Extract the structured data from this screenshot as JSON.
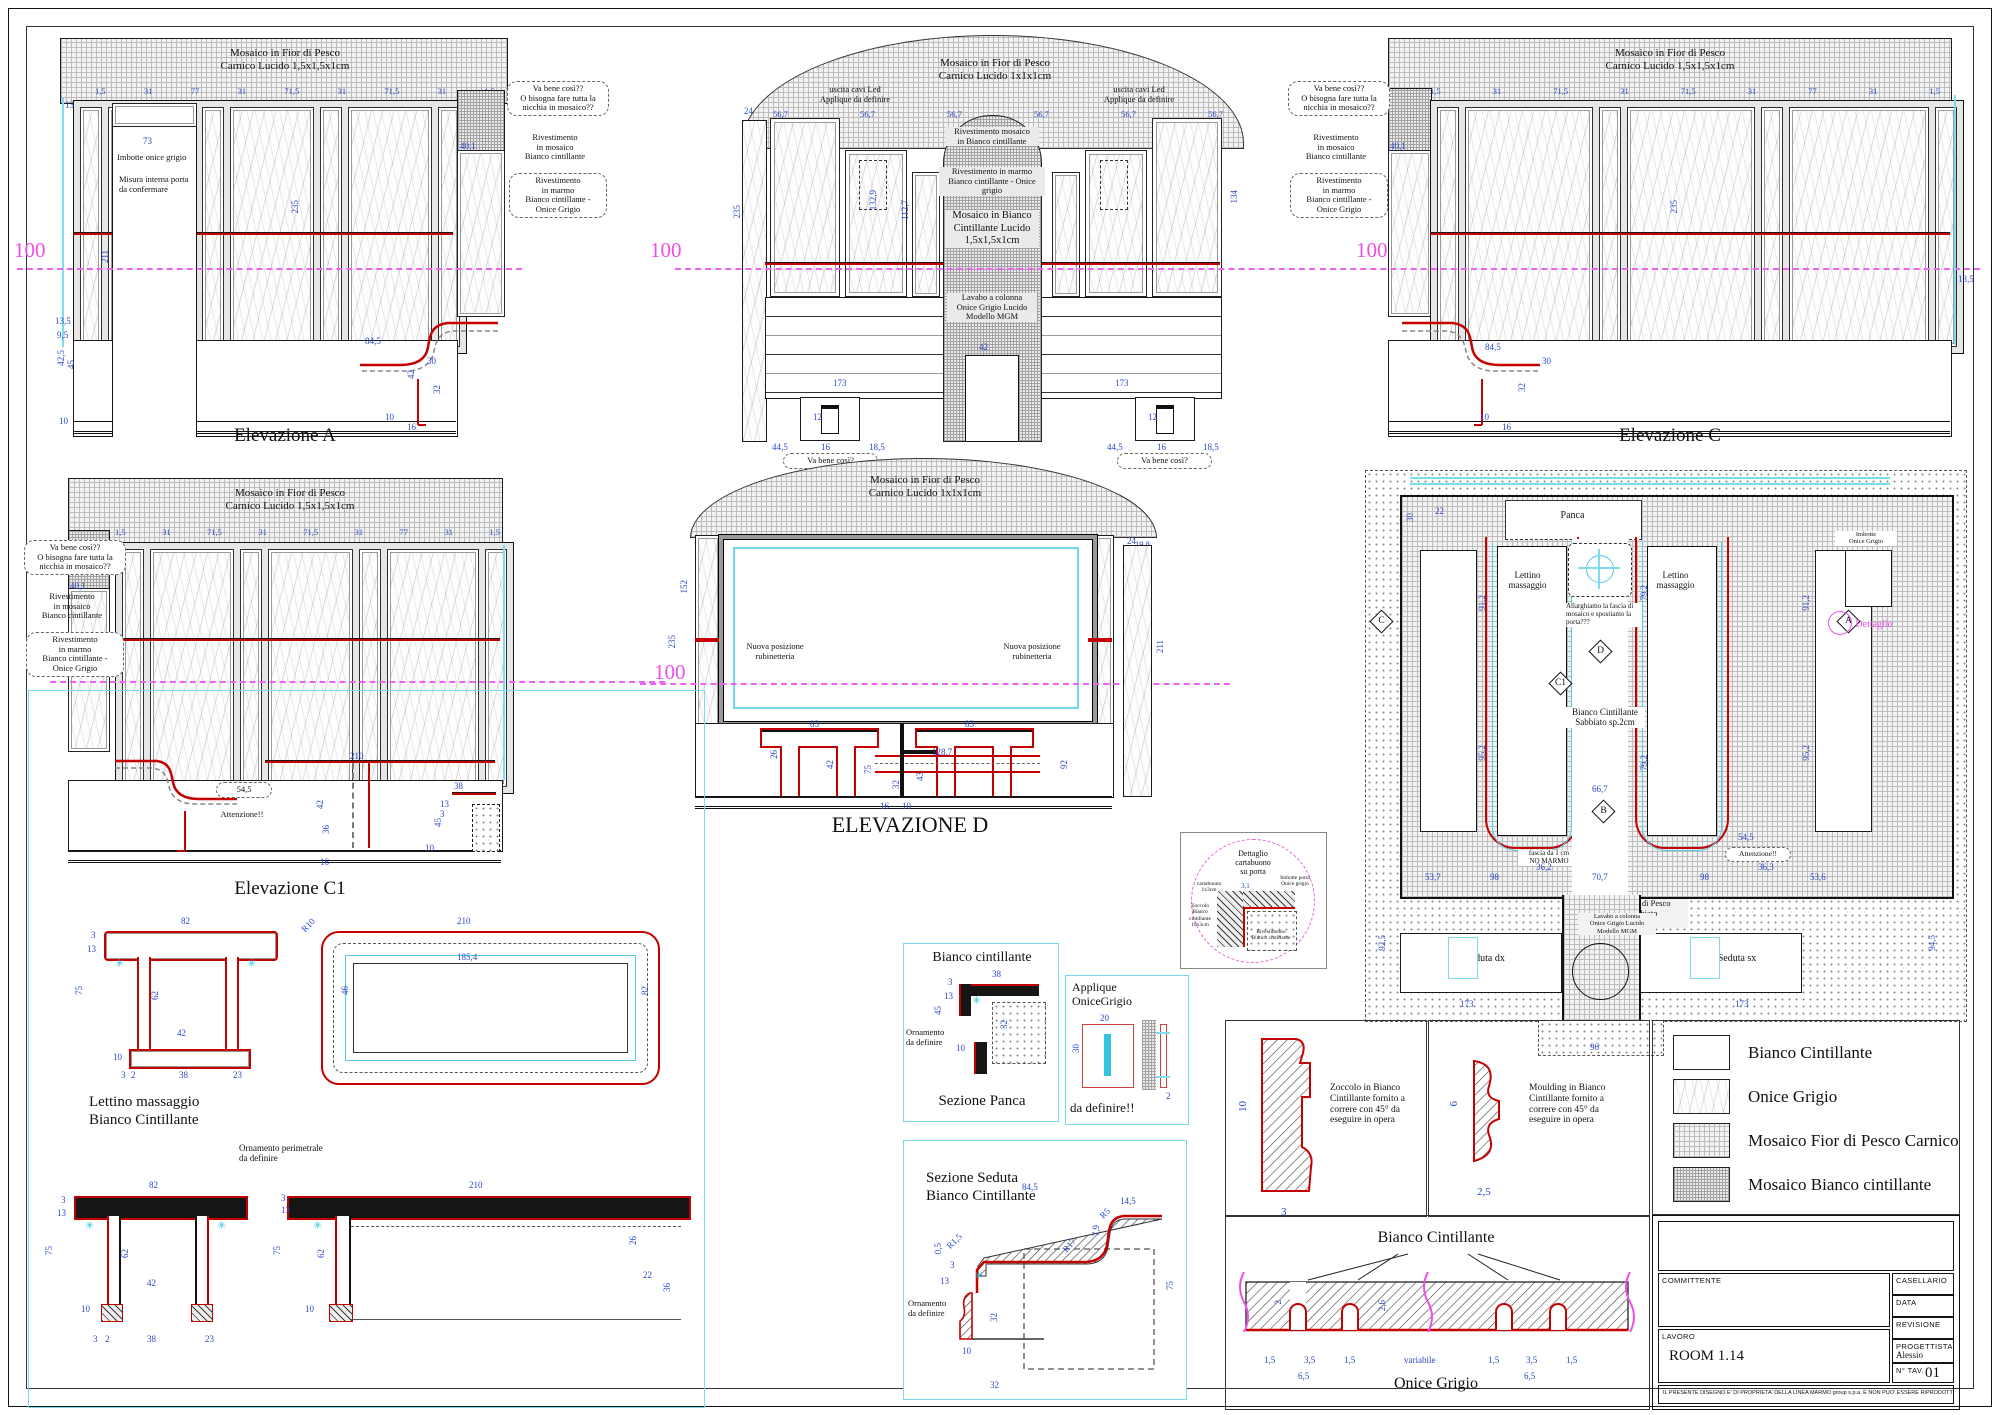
{
  "sheet": {
    "level": "100"
  },
  "elevA": {
    "title": "Elevazione A",
    "mosaic": "Mosaico in Fior di Pesco\nCarnico Lucido 1,5x1,5x1cm",
    "top_dims": [
      "1,5",
      "31",
      "77",
      "31",
      "71,5",
      "31",
      "71,5",
      "31",
      "1,5"
    ],
    "dims": {
      "d13": "13",
      "door_w": "73",
      "h_door": "211",
      "h_panel": "235",
      "niche": "40,1",
      "l1": "13,5",
      "l2": "9,5",
      "l3": "42,5",
      "l4": "45",
      "l5": "10",
      "s1": "84,5",
      "s2": "30",
      "s3": "42",
      "s4": "32",
      "s5": "16",
      "s6": "10"
    },
    "notes": {
      "imbotte": "Imbotte onice grigio",
      "misura": "Misura interna porta\nda confermare",
      "q1": "Va bene così??\nO bisogna fare tutta la\nnicchia in mosaico??",
      "rmos": "Rivestimento\nin mosaico\nBianco cintillante",
      "rmarmo": "Rivestimento\nin marmo\nBianco cintillante -\nOnice Grigio"
    }
  },
  "elevB": {
    "title": "Elevazione B",
    "mosaic": "Mosaico in Fior di Pesco\nCarnico Lucido 1x1x1cm",
    "top_dims": [
      "56,7",
      "56,7",
      "56,7",
      "56,7",
      "56,7",
      "56,7"
    ],
    "dims": {
      "d24": "24",
      "h": "235",
      "v1": "112,7",
      "v2": "132,9",
      "v3": "134",
      "lav": "42",
      "b173a": "173",
      "b173b": "173",
      "p1": "44,5",
      "p2": "16",
      "p3": "18,5",
      "p4": "44,5",
      "p5": "16",
      "p6": "18,5",
      "plug1": "12",
      "plug2": "12"
    },
    "notes": {
      "led1": "uscita cavi Led\nApplique da definire",
      "led2": "uscita cavi Led\nApplique da definire",
      "rmos": "Rivestimento mosaico\nin Bianco cintillante",
      "rmarmo": "Rivestimento in marmo\nBianco cintillante - Onice grigio",
      "mosB": "Mosaico in Bianco\nCintillante Lucido\n1,5x1,5x1cm",
      "lavabo": "Lavabo a colonna\nOnice Grigio Lucido\nModello MGM",
      "q1": "Va bene così?",
      "q2": "Va bene così?"
    }
  },
  "elevC": {
    "title": "Elevazione C",
    "mosaic": "Mosaico in Fior di Pesco\nCarnico Lucido 1,5x1,5x1cm",
    "top_dims": [
      "1,5",
      "31",
      "71,5",
      "31",
      "71,5",
      "31",
      "77",
      "31",
      "1,5"
    ],
    "dims": {
      "niche": "40,1",
      "h": "235",
      "r1": "13,5",
      "s1": "84,5",
      "s2": "30",
      "s3": "32",
      "s4": "16",
      "s5": "10"
    },
    "notes": {
      "q1": "Va bene così??\nO bisogna fare tutta la\nnicchia in mosaico??",
      "rmos": "Rivestimento\nin mosaico\nBianco cintillante",
      "rmarmo": "Rivestimento\nin marmo\nBianco cintillante -\nOnice Grigio"
    }
  },
  "elevC1": {
    "title": "Elevazione C1",
    "mosaic": "Mosaico in Fior di Pesco\nCarnico Lucido 1,5x1,5x1cm",
    "top_dims": [
      "1,5",
      "31",
      "71,5",
      "31",
      "71,5",
      "31",
      "77",
      "31",
      "1,5"
    ],
    "dims": {
      "niche": "40,1",
      "d11": "11",
      "att": "54,5",
      "c210": "210",
      "c42": "42",
      "c45": "45",
      "c38": "38",
      "c13": "13",
      "c3": "3",
      "c10": "10",
      "c36": "36",
      "c16": "16"
    },
    "notes": {
      "q1": "Va bene così??\nO bisogna fare tutta la\nnicchia in mosaico??",
      "rmos": "Rivestimento\nin mosaico\nBianco cintillante",
      "rmarmo": "Rivestimento\nin marmo\nBianco cintillante -\nOnice Grigio",
      "att": "Attenzione!!"
    }
  },
  "elevD": {
    "title": "ELEVAZIONE D",
    "mosaic": "Mosaico in Fior di Pesco\nCarnico Lucido 1x1x1cm",
    "top_dims": [
      "19,8",
      "1,5",
      "97,2",
      "97,2",
      "97,1",
      "97,2",
      "1,5",
      "19,8"
    ],
    "dims": {
      "v152": "152",
      "v235": "235",
      "v211": "211",
      "d24": "24",
      "w1287": "128,7",
      "w83a": "83",
      "w83b": "83",
      "d26": "26",
      "d42": "42",
      "d75": "75",
      "d92": "92",
      "d43": "43",
      "d32": "32",
      "d16": "16",
      "d10": "10"
    },
    "notes": {
      "rub1": "Nuova posizione\nrubinetteria",
      "rub2": "Nuova posizione\nrubinetteria"
    }
  },
  "plan": {
    "labels": {
      "panca": "Panca",
      "lettino1": "Lettino\nmassaggio",
      "lettino2": "Lettino\nmassaggio",
      "allarghiamo": "Allarghiamo la fascia di\nmosaico e spostiamo la\nporta???",
      "bianco": "Bianco Cintillante\nSabbiato sp.2cm",
      "fascia": "fascia da 1 cm\nNO MARMO",
      "att": "Attenzione!!",
      "mosaico": "Mosaico in Fior di Pesco\nCarnico Sabbiato\n1,5x1,5x1cm",
      "seduta_dx": "Seduta dx",
      "seduta_sx": "Seduta sx",
      "lavabo": "Lavabo a colonna\nOnice Grigio Lucido\nModello MGM",
      "imbotte": "Imbotte\nOnice Grigio",
      "dettaglio": "Dettaglio"
    },
    "markers": [
      "C",
      "D",
      "C1",
      "A",
      "B"
    ],
    "dims": {
      "p22": "22",
      "v912a": "91,2",
      "v912b": "91,2",
      "v952a": "95,2",
      "v952b": "95,2",
      "v792a": "79,2",
      "v792b": "79,2",
      "w667": "66,7",
      "w362": "36,2",
      "w363": "36,3",
      "w707": "70,7",
      "w98a": "98",
      "w98b": "98",
      "w537": "53,7",
      "w536": "53,6",
      "b173a": "173",
      "b173b": "173",
      "v925": "92,5",
      "v945": "94,5",
      "w545": "54,5",
      "w96": "96",
      "d30": "30"
    }
  },
  "details": {
    "lettino": {
      "title": "Lettino massaggio\nBianco Cintillante",
      "ornamento": "Ornamento perimetrale\nda definire",
      "sec": {
        "w82": "82",
        "t3": "3",
        "t13": "13",
        "h75": "75",
        "leg62": "62",
        "sp42": "42",
        "b10": "10",
        "b3": "3",
        "b2": "2",
        "b38": "38",
        "b23": "23"
      },
      "plan": {
        "w210": "210",
        "i1854": "185,4",
        "r10": "R10",
        "d46": "46",
        "d82": "82"
      },
      "sec2": {
        "w82": "82",
        "t3": "3",
        "t13": "13",
        "h75": "75",
        "leg62": "62",
        "sp42": "42",
        "b10": "10",
        "b3": "3",
        "b2": "2",
        "b38": "38",
        "b23": "23"
      },
      "side": {
        "w210": "210",
        "h75": "75",
        "leg62": "62",
        "t13": "13",
        "t3": "3",
        "b10": "10",
        "d26": "26",
        "d22": "22",
        "d36": "36"
      }
    },
    "panca": {
      "material": "Bianco cintillante",
      "caption": "Sezione Panca",
      "ornamento": "Ornamento\nda definire",
      "dims": {
        "d38": "38",
        "d3": "3",
        "d13": "13",
        "d45": "45",
        "d32": "32",
        "d10": "10"
      }
    },
    "applique": {
      "title": "Applique\nOniceGrigio",
      "note": "da definire!!",
      "dims": {
        "w": "20",
        "h": "30",
        "t": "2"
      }
    },
    "seduta": {
      "title": "Sezione Seduta\nBianco Cintillante",
      "ornamento": "Ornamento\nda definire",
      "dims": {
        "w": "84,5",
        "d145": "14,5",
        "r5": "R5",
        "d79": "7,9",
        "r17": "R17",
        "r15": "R1,5",
        "d05": "0,5",
        "d3": "3",
        "d13": "13",
        "d32": "32",
        "d10": "10",
        "h": "75",
        "b32": "32"
      }
    },
    "porta": {
      "title": "Dettaglio\ncartabuono\nsu porta",
      "labels": {
        "cartabuono": "cartabuono 1x3cm",
        "imbotte": "Imbotte porta\nOnice grigio",
        "zoccolo": "Zoccolo\nBianco\ncintillante\n10x3cm",
        "rivestimento": "Rivestimento\nBianco cintillante"
      },
      "dim": "3,1"
    },
    "zoccolo": {
      "label": "Zoccolo in Bianco\nCintillante fornito a\ncorrere con 45° da\neseguire in opera",
      "dims": {
        "h": "10",
        "w": "3"
      }
    },
    "moulding": {
      "label": "Moulding in Bianco\nCintillante fornito a\ncorrere con 45° da\neseguire in opera",
      "dims": {
        "h": "6",
        "w": "2,5"
      }
    },
    "strip": {
      "top": "Bianco Cintillante",
      "bottom": "Onice Grigio",
      "dims": {
        "a": "1,5",
        "b": "3,5",
        "c": "1,5",
        "v": "variabile",
        "d": "1,5",
        "e": "3,5",
        "f": "1,5",
        "g": "6,5",
        "h2": "6,5",
        "t": "2,6",
        "t2": "2"
      }
    }
  },
  "legend": {
    "items": [
      {
        "label": "Bianco Cintillante",
        "swatch": "plain"
      },
      {
        "label": "Onice Grigio",
        "swatch": "onyx"
      },
      {
        "label": "Mosaico Fior di Pesco Carnico",
        "swatch": "mosaic-fine"
      },
      {
        "label": "Mosaico Bianco cintillante",
        "swatch": "mosaic-dense"
      }
    ]
  },
  "titleblock": {
    "committente": "COMMITTENTE",
    "casellario": "CASELLARIO",
    "data": "DATA",
    "revisione": "REVISIONE",
    "lavoro": "LAVORO",
    "room": "ROOM 1.14",
    "progettista": "PROGETTISTA",
    "progettista_name": "Alessio",
    "ntav": "N° TAV.",
    "tav": "01",
    "disclaimer": "IL PRESENTE DISEGNO E' DI PROPRIETA' DELLA LINEA MARMO group s.p.a. E NON PUO' ESSERE RIPRODOTTO SENZA PREVENTIVA AUTORIZZAZIONE SCRITTA"
  }
}
